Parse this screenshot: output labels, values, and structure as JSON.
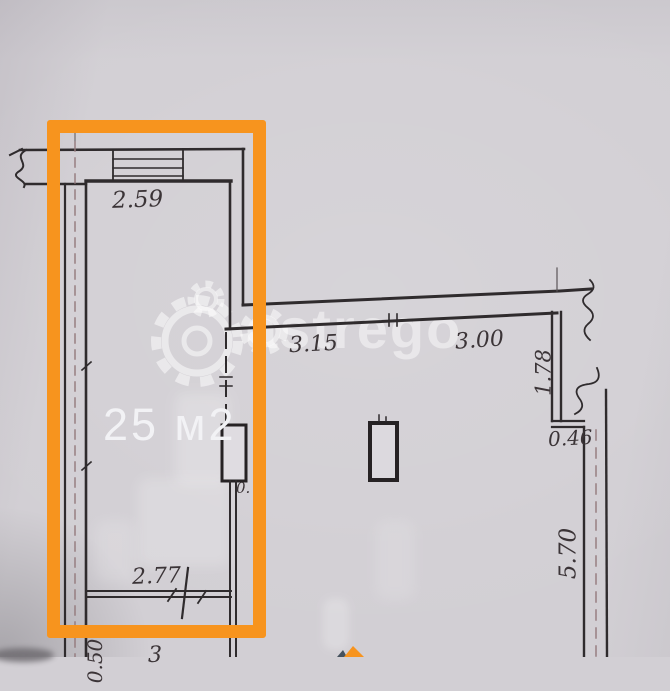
{
  "watermark": {
    "text": "astrego",
    "icon": "gear-icon"
  },
  "room": {
    "area_label": "25 м2"
  },
  "dims": {
    "top_width": "2.59",
    "corridor_left": "3.15",
    "corridor_right": "3.00",
    "niche_depth": "1.78",
    "ledge_width": "0.46",
    "right_wall_length": "5.70",
    "room_bottom_width": "2.77",
    "wall_fragment": "0.",
    "bottom_left_cut": "0.50",
    "bottom_center_cut": "3"
  },
  "colors": {
    "highlight_orange": "#f7941e",
    "paper": "#d2cfd4",
    "ink": "#2f2b2d",
    "watermark_white": "rgba(255,255,255,0.46)"
  }
}
